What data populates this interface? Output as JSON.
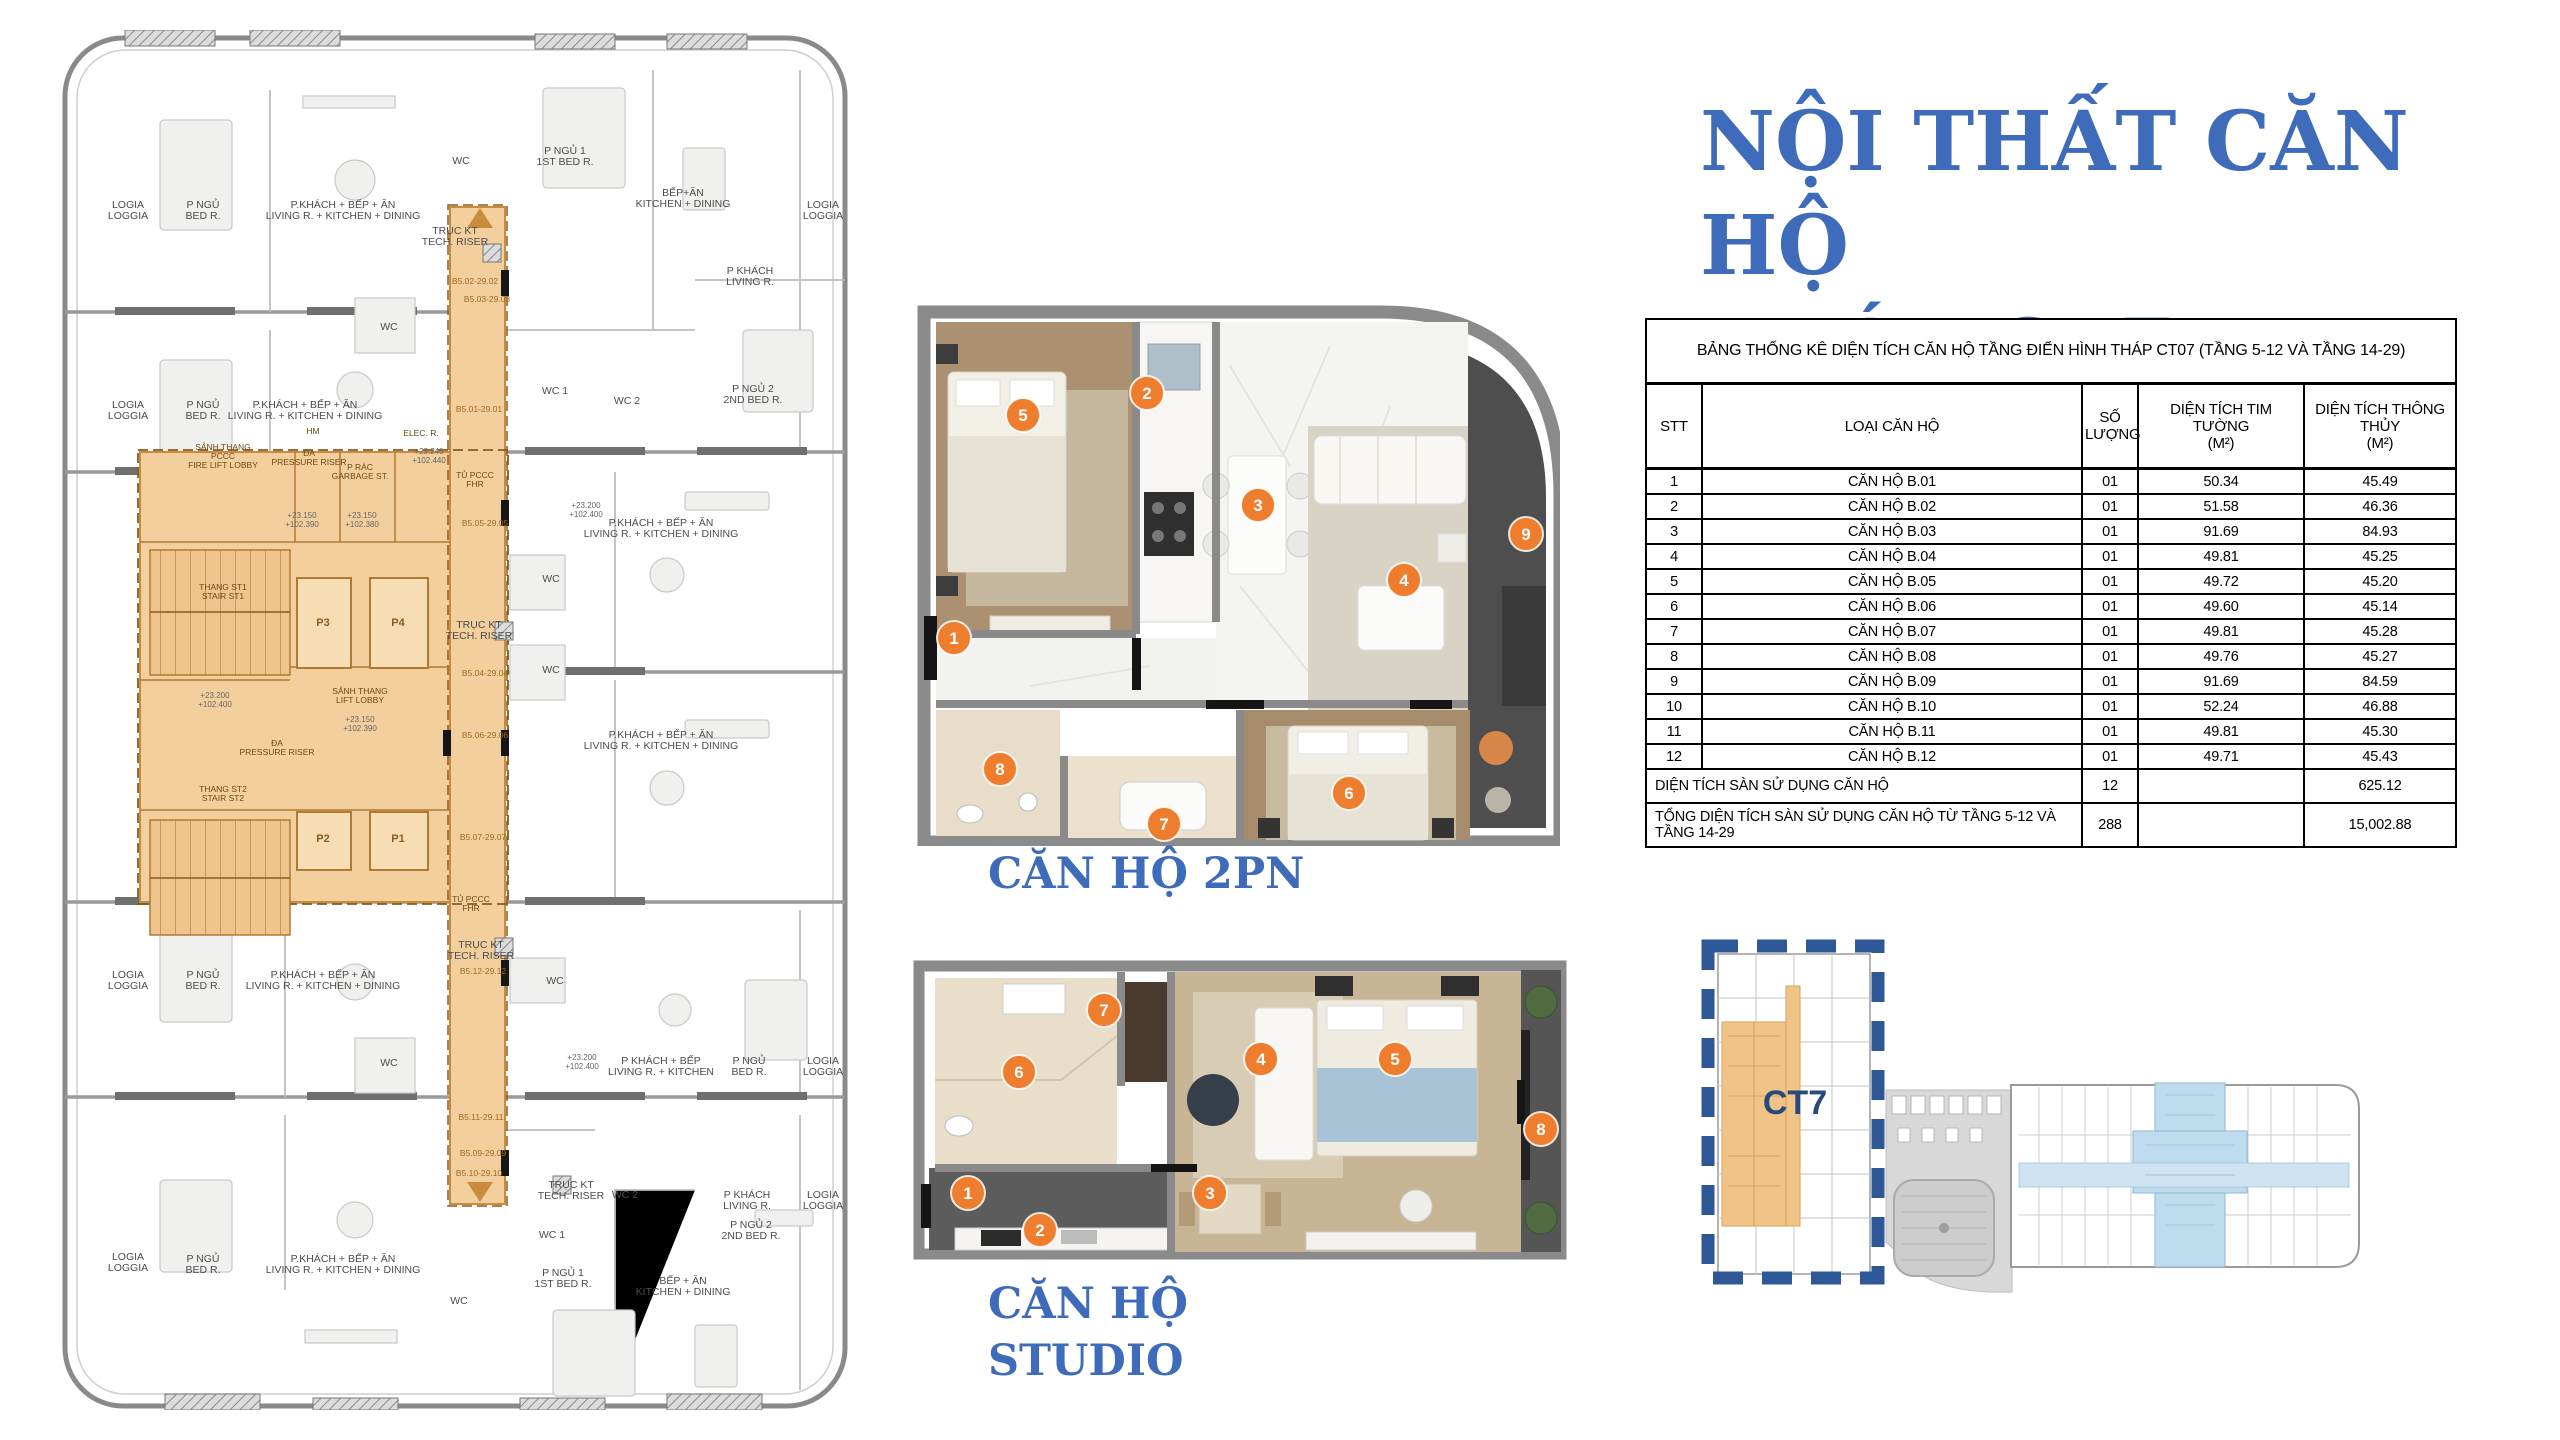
{
  "title": {
    "lines": [
      "NỘI THẤT CĂN",
      "HỘ",
      "THÁP CT7"
    ],
    "color": "#3e6bba"
  },
  "sections": {
    "apartment_2pn_label": "CĂN HỘ 2PN",
    "apartment_studio_lines": [
      "CĂN HỘ",
      "STUDIO"
    ]
  },
  "table": {
    "caption": "BẢNG THỐNG KÊ DIỆN TÍCH CĂN HỘ TẦNG ĐIỂN HÌNH THÁP CT07 (TẦNG 5-12 VÀ TẦNG 14-29)",
    "columns": [
      "STT",
      "LOẠI CĂN HỘ",
      "SỐ\nLƯỢNG",
      "DIỆN TÍCH TIM TƯỜNG\n(M²)",
      "DIỆN TÍCH THÔNG THỦY\n(M²)"
    ],
    "rows": [
      [
        "1",
        "CĂN HỘ B.01",
        "01",
        "50.34",
        "45.49"
      ],
      [
        "2",
        "CĂN HỘ B.02",
        "01",
        "51.58",
        "46.36"
      ],
      [
        "3",
        "CĂN HỘ B.03",
        "01",
        "91.69",
        "84.93"
      ],
      [
        "4",
        "CĂN HỘ B.04",
        "01",
        "49.81",
        "45.25"
      ],
      [
        "5",
        "CĂN HỘ B.05",
        "01",
        "49.72",
        "45.20"
      ],
      [
        "6",
        "CĂN HỘ B.06",
        "01",
        "49.60",
        "45.14"
      ],
      [
        "7",
        "CĂN HỘ B.07",
        "01",
        "49.81",
        "45.28"
      ],
      [
        "8",
        "CĂN HỘ B.08",
        "01",
        "49.76",
        "45.27"
      ],
      [
        "9",
        "CĂN HỘ B.09",
        "01",
        "91.69",
        "84.59"
      ],
      [
        "10",
        "CĂN HỘ B.10",
        "01",
        "52.24",
        "46.88"
      ],
      [
        "11",
        "CĂN HỘ B.11",
        "01",
        "49.81",
        "45.30"
      ],
      [
        "12",
        "CĂN HỘ B.12",
        "01",
        "49.71",
        "45.43"
      ]
    ],
    "totals": [
      {
        "label": "DIỆN TÍCH SÀN SỬ DỤNG CĂN HỘ",
        "so_luong": "12",
        "tim_tuong": "",
        "thong_thuy": "625.12"
      },
      {
        "label": "TỔNG DIỆN TÍCH SÀN SỬ DỤNG CĂN HỘ TỪ TẦNG 5-12 VÀ TẦNG 14-29",
        "so_luong": "288",
        "tim_tuong": "",
        "thong_thuy": "15,002.88"
      }
    ]
  },
  "minimap": {
    "tower_label": "CT7",
    "dash_color": "#2d5796",
    "label_color": "#26497e",
    "highlight_orange": "#f0c387",
    "highlight_blue": "#bfdcee"
  },
  "colors": {
    "accent_blue": "#3e6bba",
    "marker_orange": "#ee7d2d",
    "core_orange": "#f3cf9d",
    "core_line": "#c98c3e"
  },
  "floorplan": {
    "room_labels": [
      [
        "LOGIA\nLOGGIA",
        73,
        178
      ],
      [
        "P NGỦ\nBED R.",
        148,
        178
      ],
      [
        "P.KHÁCH + BẾP + ĂN\nLIVING R. + KITCHEN + DINING",
        288,
        178
      ],
      [
        "WC",
        406,
        134
      ],
      [
        "TRỤC KT\nTECH. RISER",
        400,
        204
      ],
      [
        "P NGỦ 1\n1ST BED R.",
        510,
        124
      ],
      [
        "BẾP+ĂN\nKITCHEN + DINING",
        628,
        166
      ],
      [
        "LOGIA\nLOGGIA",
        768,
        178
      ],
      [
        "P KHÁCH\nLIVING R.",
        695,
        244
      ],
      [
        "P NGỦ 2\n2ND BED R.",
        698,
        362
      ],
      [
        "WC 1",
        500,
        364
      ],
      [
        "WC 2",
        572,
        374
      ],
      [
        "LOGIA\nLOGGIA",
        73,
        378
      ],
      [
        "P NGỦ\nBED R.",
        148,
        378
      ],
      [
        "P.KHÁCH + BẾP + ĂN\nLIVING R. + KITCHEN + DINING",
        250,
        378
      ],
      [
        "WC",
        334,
        300
      ],
      [
        "WC",
        496,
        552
      ],
      [
        "WC",
        496,
        643
      ],
      [
        "P.KHÁCH + BẾP + ĂN\nLIVING R. + KITCHEN + DINING",
        606,
        496
      ],
      [
        "P.KHÁCH + BẾP + ĂN\nLIVING R. + KITCHEN + DINING",
        606,
        708
      ],
      [
        "TRỤC KT\nTECH. RISER",
        424,
        598
      ],
      [
        "LOGIA\nLOGGIA",
        73,
        948
      ],
      [
        "P NGỦ\nBED R.",
        148,
        948
      ],
      [
        "P.KHÁCH + BẾP + ĂN\nLIVING R. + KITCHEN + DINING",
        268,
        948
      ],
      [
        "WC",
        334,
        1036
      ],
      [
        "WC",
        500,
        954
      ],
      [
        "TRỤC KT\nTECH. RISER",
        426,
        918
      ],
      [
        "P KHÁCH + BẾP\nLIVING R. + KITCHEN",
        606,
        1034
      ],
      [
        "P NGỦ\nBED R.",
        694,
        1034
      ],
      [
        "LOGIA\nLOGGIA",
        768,
        1034
      ],
      [
        "P KHÁCH\nLIVING R.",
        692,
        1168
      ],
      [
        "LOGIA\nLOGGIA",
        768,
        1168
      ],
      [
        "P NGỦ 2\n2ND BED R.",
        696,
        1198
      ],
      [
        "WC 2",
        570,
        1168
      ],
      [
        "WC 1",
        497,
        1208
      ],
      [
        "TRỤC KT\nTECH. RISER",
        516,
        1158
      ],
      [
        "LOGIA\nLOGGIA",
        73,
        1230
      ],
      [
        "P NGỦ\nBED R.",
        148,
        1232
      ],
      [
        "P.KHÁCH + BẾP + ĂN\nLIVING R. + KITCHEN + DINING",
        288,
        1232
      ],
      [
        "WC",
        404,
        1274
      ],
      [
        "P NGỦ 1\n1ST BED R.",
        508,
        1246
      ],
      [
        "BẾP + ĂN\nKITCHEN + DINING",
        628,
        1254
      ]
    ],
    "core_labels": [
      [
        "SẢNH THANG\nPCCC\nFIRE LIFT LOBBY",
        168,
        420
      ],
      [
        "ĐA\nPRESSURE RISER",
        254,
        426
      ],
      [
        "HM",
        258,
        404
      ],
      [
        "P RÁC\nGARBAGE ST.",
        305,
        440
      ],
      [
        "ELEC. R.",
        366,
        406
      ],
      [
        "THANG ST1\nSTAIR ST1",
        168,
        560
      ],
      [
        "SẢNH THANG\nLIFT LOBBY",
        305,
        664
      ],
      [
        "ĐA\nPRESSURE RISER",
        222,
        716
      ],
      [
        "THANG ST2\nSTAIR ST2",
        168,
        762
      ],
      [
        "TỦ PCCC\nFHR",
        420,
        448
      ],
      [
        "TỦ PCCC\nFHR",
        416,
        872
      ]
    ],
    "lift_labels": [
      [
        "P3",
        268,
        596
      ],
      [
        "P4",
        343,
        596
      ],
      [
        "P2",
        268,
        812
      ],
      [
        "P1",
        343,
        812
      ]
    ],
    "elev_marks": [
      [
        "+23.200\n+102.400",
        160,
        668
      ],
      [
        "+23.150\n+102.390",
        247,
        488
      ],
      [
        "+23.150\n+102.380",
        307,
        488
      ],
      [
        "+23.240\n+102.440",
        374,
        424
      ],
      [
        "+23.150\n+102.390",
        305,
        692
      ],
      [
        "+23.200\n+102.400",
        531,
        478
      ],
      [
        "+23.200\n+102.400",
        527,
        1030
      ]
    ],
    "unit_tags": [
      [
        "B5.02-29.02",
        420,
        254
      ],
      [
        "B5.03-29.03",
        432,
        272
      ],
      [
        "B5.01-29.01",
        424,
        382
      ],
      [
        "B5.05-29.05",
        430,
        496
      ],
      [
        "B5.04-29.04",
        430,
        646
      ],
      [
        "B5.06-29.06",
        430,
        708
      ],
      [
        "B5.07-29.07",
        428,
        810
      ],
      [
        "B5.12-29.12",
        428,
        944
      ],
      [
        "B5.11-29.11",
        426,
        1090
      ],
      [
        "B5.09-29.09",
        428,
        1126
      ],
      [
        "B5.10-29.10",
        424,
        1146
      ]
    ]
  },
  "render_2pn": {
    "markers": [
      [
        1,
        44,
        352
      ],
      [
        2,
        237,
        107
      ],
      [
        3,
        348,
        219
      ],
      [
        4,
        494,
        294
      ],
      [
        5,
        113,
        129
      ],
      [
        6,
        439,
        507
      ],
      [
        7,
        254,
        538
      ],
      [
        8,
        90,
        483
      ],
      [
        9,
        616,
        248
      ]
    ]
  },
  "render_studio": {
    "markers": [
      [
        1,
        57,
        253
      ],
      [
        2,
        129,
        290
      ],
      [
        3,
        299,
        253
      ],
      [
        4,
        350,
        119
      ],
      [
        5,
        484,
        119
      ],
      [
        6,
        108,
        132
      ],
      [
        7,
        193,
        70
      ],
      [
        8,
        630,
        189
      ]
    ]
  }
}
